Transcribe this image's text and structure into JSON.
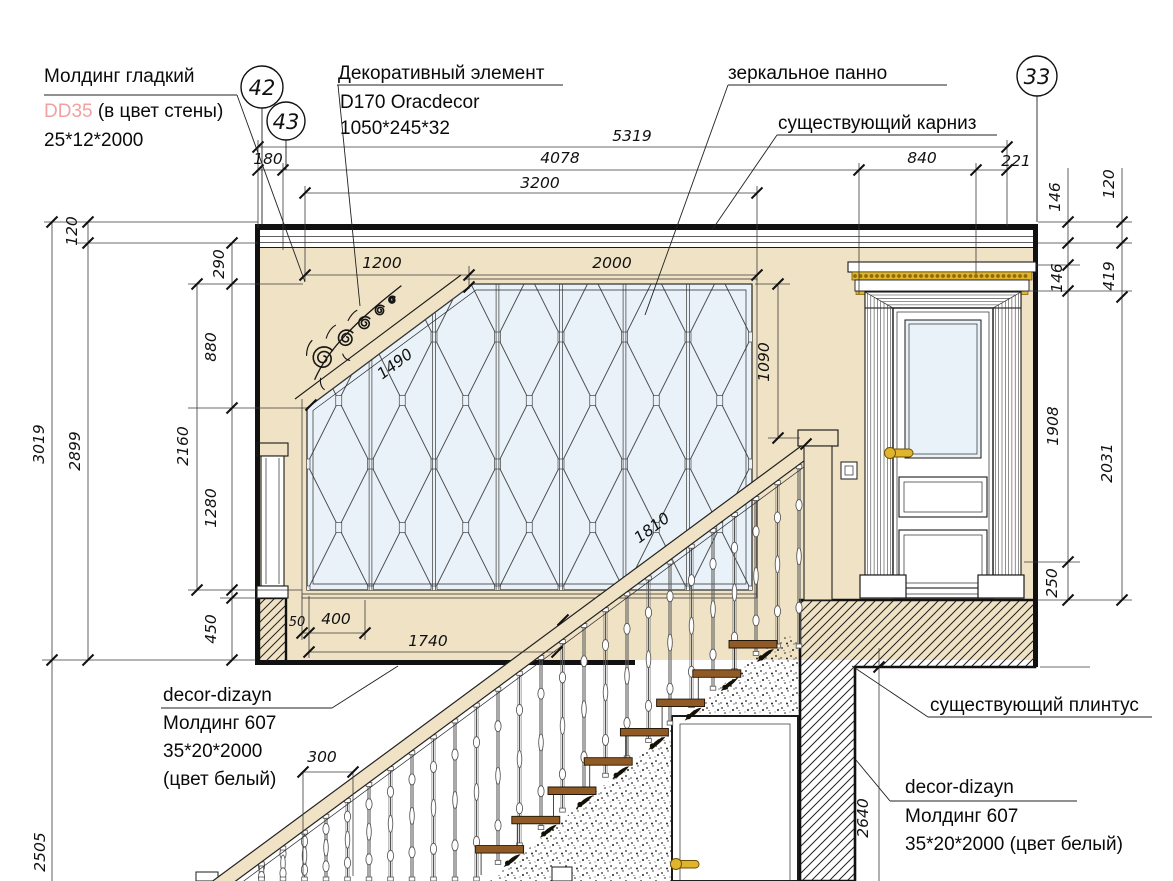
{
  "colors": {
    "wall_beige": "#f0e2c5",
    "glass_blue": "#e9f2f8",
    "accent_pink": "#f2a1a1",
    "gold": "#dfb52e",
    "gold_dark": "#8f6a08",
    "wood_brown": "#8f5a25",
    "line_dark": "#1b1b1b"
  },
  "callouts": {
    "n42": "42",
    "n43": "43",
    "n33": "33"
  },
  "labels": {
    "molding_smooth": {
      "l1": "Молдинг гладкий",
      "l2a": "DD35",
      "l2b": " (в цвет стены)",
      "l3": "25*12*2000"
    },
    "decor_element": {
      "l1": "Декоративный элемент",
      "l2": "D170 Oracdecor",
      "l3": "1050*245*32"
    },
    "mirror_panel": "зеркальное панно",
    "existing_cornice": "существующий карниз",
    "existing_plinth": "существующий плинтус",
    "molding_left": {
      "l1": "decor-dizayn",
      "l2": "Молдинг 607",
      "l3": "35*20*2000",
      "l4": "(цвет белый)"
    },
    "molding_right": {
      "l1": "decor-dizayn",
      "l2": "Молдинг 607",
      "l3": "35*20*2000 (цвет белый)"
    }
  },
  "dims": {
    "total_width": "5319",
    "seg_180": "180",
    "seg_4078": "4078",
    "seg_840": "840",
    "seg_221": "221",
    "mirror_zone": "3200",
    "mirror_diag_w": "1200",
    "mirror_top_w": "2000",
    "diag_len": "1490",
    "mirror_right_h": "1090",
    "left_total": "3019",
    "left_inner": "2899",
    "cornice_h": "120",
    "top_gap": "290",
    "diag_h": "880",
    "mirror_h": "2160",
    "lower_h": "1280",
    "base_h": "450",
    "below_floor": "2505",
    "frame_50": "50",
    "frame_400": "400",
    "base_len": "1740",
    "rail_len": "1810",
    "baluster_gap": "300",
    "right_below": "2640",
    "r_146a": "146",
    "r_120": "120",
    "r_146b": "146",
    "r_419": "419",
    "door_h": "1908",
    "door_total": "2031",
    "r_250": "250"
  }
}
